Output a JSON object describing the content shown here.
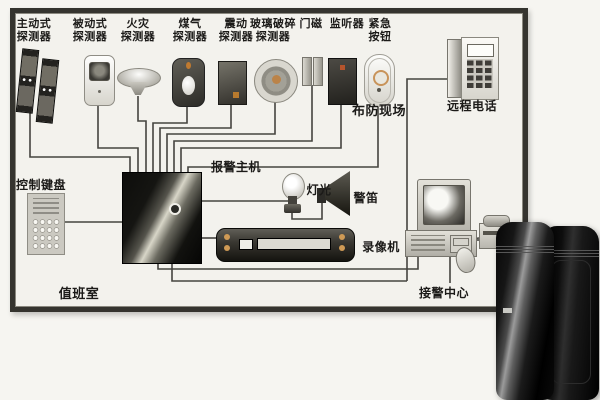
{
  "diagram": {
    "detectors": [
      {
        "id": "active",
        "line1": "主动式",
        "line2": "探测器"
      },
      {
        "id": "passive",
        "line1": "被动式",
        "line2": "探测器"
      },
      {
        "id": "fire",
        "line1": "火灾",
        "line2": "探测器"
      },
      {
        "id": "gas",
        "line1": "煤气",
        "line2": "探测器"
      },
      {
        "id": "vibration",
        "line1": "震动",
        "line2": "探测器"
      },
      {
        "id": "glass_break",
        "line1": "玻璃破碎",
        "line2": "探测器"
      },
      {
        "id": "door_magnet",
        "line1": "门磁",
        "line2": ""
      },
      {
        "id": "listener",
        "line1": "监听器",
        "line2": ""
      },
      {
        "id": "emergency",
        "line1": "紧急",
        "line2": "按钮"
      }
    ],
    "labels": {
      "remote_phone": "远程电话",
      "armed_site": "布防现场",
      "alarm_host": "报警主机",
      "control_keypad": "控制键盘",
      "light": "灯光",
      "siren": "警笛",
      "vcr": "录像机",
      "alarm_center": "接警中心",
      "duty_room": "值班室"
    },
    "colors": {
      "wire": "#45443f",
      "frame": "#35342f",
      "paper": "#f3f2ed",
      "accent_orange": "#bb8348"
    }
  }
}
